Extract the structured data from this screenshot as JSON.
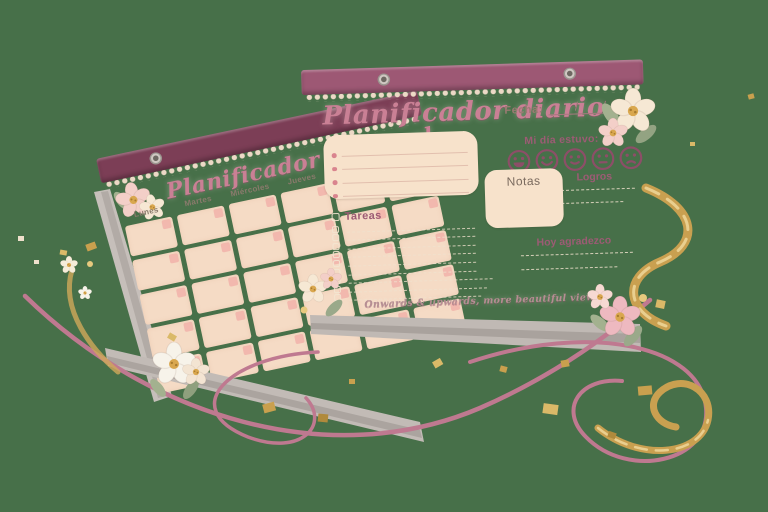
{
  "scene_description": "Two floral planner notepads product shot on green background with gold confetti and ribbons",
  "colors": {
    "bg": "#477049",
    "binding_daily": "#9d5874",
    "binding_monthly": "#7c3e56",
    "title_pink": "#ca8095",
    "paper": "#f7e2cb",
    "cell": "#f5dbc5",
    "corner_pink": "#f2b4ab",
    "maroon": "#8d4e68",
    "gold": "#c9a050",
    "ribbon_pink": "#bf7990",
    "page_gray": "#bcb5b0"
  },
  "daily": {
    "title": "Planificador diario",
    "fecha_label": "Fecha:",
    "slash": "/",
    "mood_label": "Mi día estuvo:",
    "mood_icons": [
      "very-happy",
      "happy",
      "slight-smile",
      "neutral",
      "sad"
    ],
    "notas_label": "Notas",
    "logros_label": "Logros",
    "tareas_label": "Tareas",
    "gratitude_label": "Hoy agradezco",
    "quote": "Onwards & upwards, more beautiful views",
    "note_line_count": 4,
    "task_row_count": 9
  },
  "monthly": {
    "title": "Planificador mensual",
    "day_headers": [
      "Lunes",
      "Martes",
      "Miércoles",
      "Jueves",
      "Viernes"
    ],
    "calendar_rows": 5,
    "calendar_cols": 6
  }
}
